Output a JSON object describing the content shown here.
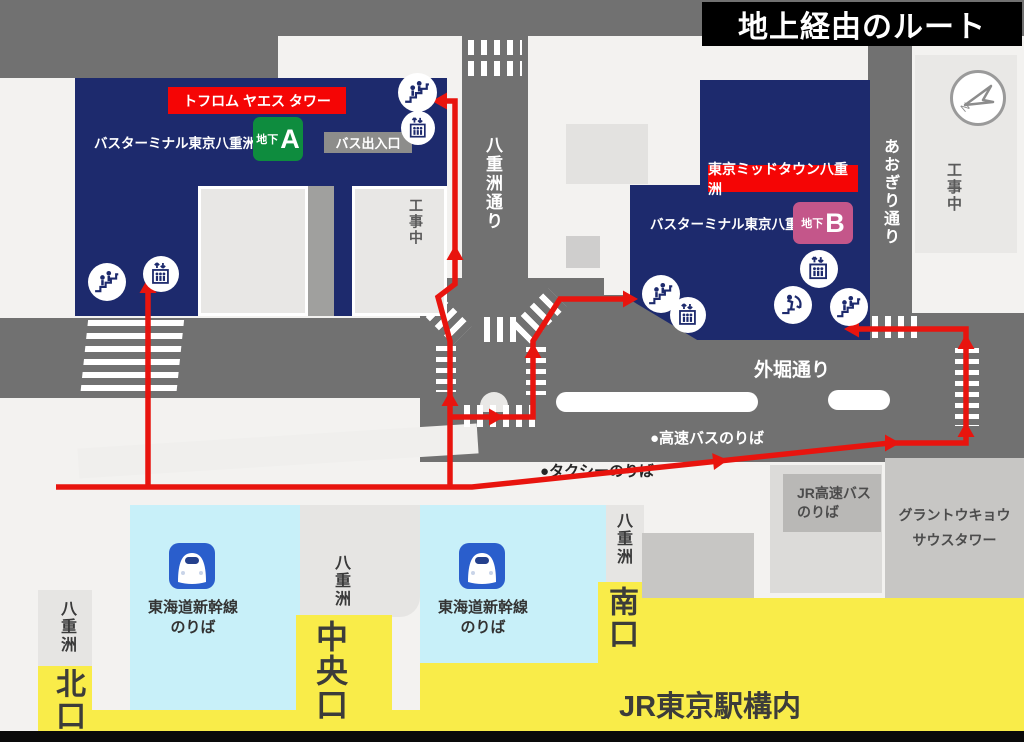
{
  "title": "地上経由のルート",
  "compass": {
    "letter": "N"
  },
  "buildings": {
    "tofrom_tower": "トフロム ヤエス タワー",
    "midtown": "東京ミッドタウン八重洲",
    "bus_terminal": "バスターミナル東京八重洲",
    "basement": "地下",
    "gate_a": "A",
    "gate_b": "B",
    "bus_entrance": "バス出入口",
    "under_construction": "工事中",
    "gran_tokyo_1": "グラントウキョウ",
    "gran_tokyo_2": "サウスタワー"
  },
  "streets": {
    "yaesu_dori": "八重洲通り",
    "aogiri_dori": "あおぎり通り",
    "sotobori_dori": "外堀通り"
  },
  "stops": {
    "expressway_bus": "●高速バスのりば",
    "taxi": "●タクシーのりば",
    "jr_expressway_bus_1": "JR高速バス",
    "jr_expressway_bus_2": "のりば"
  },
  "station": {
    "shinkansen_1": "東海道新幹線",
    "shinkansen_2": "のりば",
    "yaesu": "八重洲",
    "north_gate": "北口",
    "central_gate": "中央口",
    "south_gate": "南口",
    "premises": "JR東京駅構内"
  },
  "colors": {
    "road_gray": "#717171",
    "building_navy": "#1d2a6d",
    "route_red": "#e8140e",
    "label_red": "#f50505",
    "gate_a_green": "#0e8c3e",
    "gate_b_pink": "#c4568a",
    "station_yellow": "#f9ec49",
    "shinkansen_cyan": "#c8f0f9",
    "shinkansen_blue": "#2a5ecc"
  }
}
